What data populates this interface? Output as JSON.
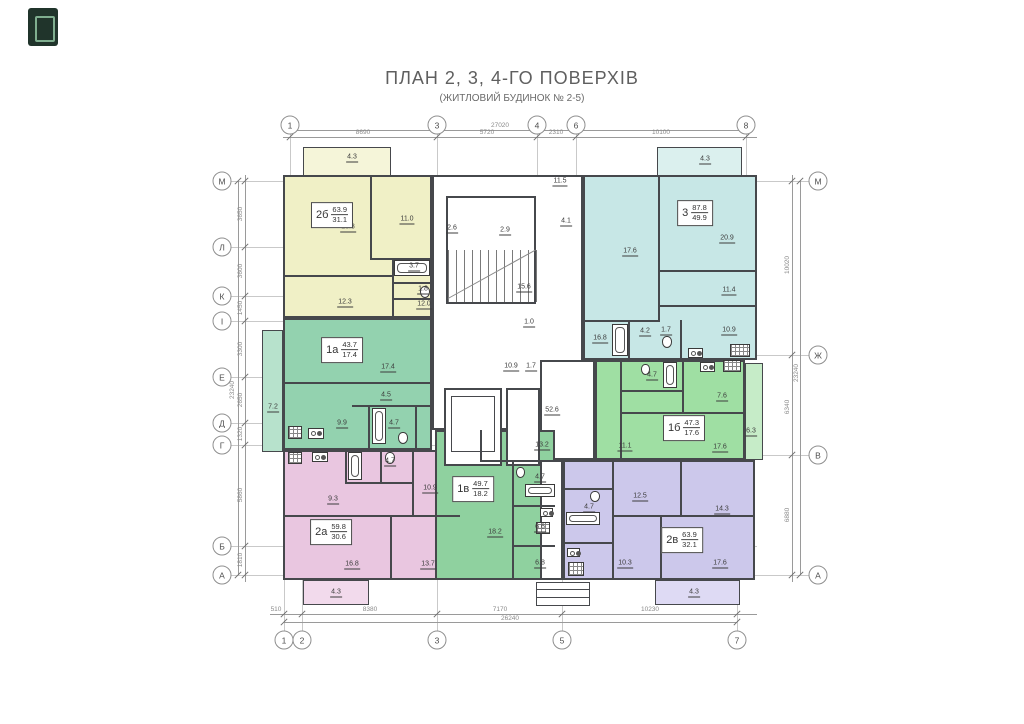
{
  "title": "ПЛАН 2, 3, 4-ГО ПОВЕРХІВ",
  "subtitle": "(ЖИТЛОВИЙ БУДИНОК № 2-5)",
  "colors": {
    "a2b": "#f0f0c6",
    "a2b_b": "#f5f5d9",
    "a3": "#c7e7e6",
    "a3_b": "#dbf0ee",
    "a1a": "#93d2af",
    "a1a_b": "#b7e2cc",
    "a1b": "#9fdfa3",
    "a1b_b": "#c6ecc8",
    "a2a": "#e9c6e0",
    "a2a_b": "#f2daec",
    "a1v": "#8fd19f",
    "a2v": "#ccc8eb",
    "a2v_b": "#dedaf4",
    "white": "#ffffff"
  },
  "apartments": [
    {
      "id": "2б",
      "total": "63.9",
      "living": "31.1",
      "x": 332,
      "y": 215
    },
    {
      "id": "3",
      "total": "87.8",
      "living": "49.9",
      "x": 695,
      "y": 213
    },
    {
      "id": "1а",
      "total": "43.7",
      "living": "17.4",
      "x": 342,
      "y": 350
    },
    {
      "id": "1б",
      "total": "47.3",
      "living": "17.6",
      "x": 684,
      "y": 428
    },
    {
      "id": "2а",
      "total": "59.8",
      "living": "30.6",
      "x": 331,
      "y": 532
    },
    {
      "id": "1в",
      "total": "49.7",
      "living": "18.2",
      "x": 473,
      "y": 489
    },
    {
      "id": "2в",
      "total": "63.9",
      "living": "32.1",
      "x": 682,
      "y": 540
    }
  ],
  "rooms": [
    {
      "x": 303,
      "y": 147,
      "w": 88,
      "h": 30,
      "f": "a2b_b",
      "thin": true
    },
    {
      "x": 657,
      "y": 147,
      "w": 85,
      "h": 30,
      "f": "a3_b",
      "thin": true
    },
    {
      "x": 283,
      "y": 175,
      "w": 149,
      "h": 143,
      "f": "a2b"
    },
    {
      "x": 432,
      "y": 175,
      "w": 151,
      "h": 255,
      "f": "white"
    },
    {
      "x": 583,
      "y": 175,
      "w": 174,
      "h": 185,
      "f": "a3"
    },
    {
      "x": 262,
      "y": 330,
      "w": 21,
      "h": 122,
      "f": "a1a_b",
      "thin": true,
      "hatch": true
    },
    {
      "x": 283,
      "y": 318,
      "w": 149,
      "h": 132,
      "f": "a1a"
    },
    {
      "x": 540,
      "y": 360,
      "w": 55,
      "h": 100,
      "f": "white"
    },
    {
      "x": 595,
      "y": 360,
      "w": 150,
      "h": 100,
      "f": "a1b"
    },
    {
      "x": 745,
      "y": 363,
      "w": 18,
      "h": 97,
      "f": "a1b_b",
      "thin": true,
      "hatch": true
    },
    {
      "x": 283,
      "y": 450,
      "w": 177,
      "h": 130,
      "f": "a2a"
    },
    {
      "x": 435,
      "y": 430,
      "w": 120,
      "h": 150,
      "f": "a1v"
    },
    {
      "x": 540,
      "y": 460,
      "w": 23,
      "h": 120,
      "f": "white"
    },
    {
      "x": 563,
      "y": 460,
      "w": 192,
      "h": 120,
      "f": "a2v"
    },
    {
      "x": 303,
      "y": 580,
      "w": 66,
      "h": 25,
      "f": "a2a_b",
      "thin": true
    },
    {
      "x": 655,
      "y": 580,
      "w": 85,
      "h": 25,
      "f": "a2v_b",
      "thin": true
    },
    {
      "x": 446,
      "y": 196,
      "w": 90,
      "h": 108,
      "f": "white"
    },
    {
      "x": 444,
      "y": 388,
      "w": 58,
      "h": 78,
      "f": "white"
    },
    {
      "x": 451,
      "y": 396,
      "w": 44,
      "h": 56,
      "f": "white",
      "thin": true
    },
    {
      "x": 506,
      "y": 388,
      "w": 34,
      "h": 78,
      "f": "white"
    },
    {
      "x": 536,
      "y": 582,
      "w": 54,
      "h": 24,
      "f": "white",
      "thin": true
    }
  ],
  "walls": [
    {
      "x": 370,
      "y": 175,
      "w": 2,
      "h": 85
    },
    {
      "x": 370,
      "y": 258,
      "w": 62,
      "h": 2
    },
    {
      "x": 392,
      "y": 258,
      "w": 2,
      "h": 60
    },
    {
      "x": 392,
      "y": 282,
      "w": 40,
      "h": 2
    },
    {
      "x": 392,
      "y": 298,
      "w": 40,
      "h": 2
    },
    {
      "x": 283,
      "y": 275,
      "w": 110,
      "h": 2
    },
    {
      "x": 658,
      "y": 177,
      "w": 2,
      "h": 143
    },
    {
      "x": 658,
      "y": 270,
      "w": 99,
      "h": 2
    },
    {
      "x": 658,
      "y": 305,
      "w": 99,
      "h": 2
    },
    {
      "x": 583,
      "y": 320,
      "w": 77,
      "h": 2
    },
    {
      "x": 628,
      "y": 320,
      "w": 2,
      "h": 40
    },
    {
      "x": 680,
      "y": 320,
      "w": 2,
      "h": 40
    },
    {
      "x": 283,
      "y": 382,
      "w": 149,
      "h": 2
    },
    {
      "x": 352,
      "y": 405,
      "w": 80,
      "h": 2
    },
    {
      "x": 368,
      "y": 405,
      "w": 2,
      "h": 45
    },
    {
      "x": 415,
      "y": 405,
      "w": 2,
      "h": 45
    },
    {
      "x": 620,
      "y": 360,
      "w": 2,
      "h": 100
    },
    {
      "x": 620,
      "y": 412,
      "w": 125,
      "h": 2
    },
    {
      "x": 620,
      "y": 390,
      "w": 62,
      "h": 2
    },
    {
      "x": 682,
      "y": 360,
      "w": 2,
      "h": 52
    },
    {
      "x": 283,
      "y": 515,
      "w": 177,
      "h": 2
    },
    {
      "x": 390,
      "y": 515,
      "w": 2,
      "h": 65
    },
    {
      "x": 412,
      "y": 450,
      "w": 2,
      "h": 65
    },
    {
      "x": 345,
      "y": 450,
      "w": 2,
      "h": 34
    },
    {
      "x": 345,
      "y": 482,
      "w": 67,
      "h": 2
    },
    {
      "x": 380,
      "y": 450,
      "w": 2,
      "h": 32
    },
    {
      "x": 512,
      "y": 460,
      "w": 2,
      "h": 120
    },
    {
      "x": 480,
      "y": 430,
      "w": 2,
      "h": 30
    },
    {
      "x": 480,
      "y": 460,
      "w": 75,
      "h": 2
    },
    {
      "x": 512,
      "y": 505,
      "w": 43,
      "h": 2
    },
    {
      "x": 512,
      "y": 545,
      "w": 43,
      "h": 2
    },
    {
      "x": 612,
      "y": 460,
      "w": 2,
      "h": 120
    },
    {
      "x": 612,
      "y": 515,
      "w": 143,
      "h": 2
    },
    {
      "x": 660,
      "y": 515,
      "w": 2,
      "h": 65
    },
    {
      "x": 680,
      "y": 460,
      "w": 2,
      "h": 55
    },
    {
      "x": 563,
      "y": 488,
      "w": 49,
      "h": 2
    },
    {
      "x": 563,
      "y": 542,
      "w": 49,
      "h": 2
    },
    {
      "x": 537,
      "y": 589,
      "w": 52,
      "h": 1
    },
    {
      "x": 537,
      "y": 597,
      "w": 52,
      "h": 1
    }
  ],
  "area_labels": [
    {
      "t": "4.3",
      "x": 352,
      "y": 158
    },
    {
      "t": "18.8",
      "x": 348,
      "y": 228
    },
    {
      "t": "11.0",
      "x": 407,
      "y": 220
    },
    {
      "t": "3.7",
      "x": 414,
      "y": 267
    },
    {
      "t": "1.8",
      "x": 423,
      "y": 290
    },
    {
      "t": "12.3",
      "x": 345,
      "y": 303
    },
    {
      "t": "12.0",
      "x": 424,
      "y": 305
    },
    {
      "t": "2.6",
      "x": 452,
      "y": 229
    },
    {
      "t": "2.9",
      "x": 505,
      "y": 231
    },
    {
      "t": "11.5",
      "x": 560,
      "y": 182
    },
    {
      "t": "4.1",
      "x": 566,
      "y": 222
    },
    {
      "t": "15.6",
      "x": 524,
      "y": 288
    },
    {
      "t": "1.0",
      "x": 529,
      "y": 323
    },
    {
      "t": "10.9",
      "x": 511,
      "y": 367
    },
    {
      "t": "1.7",
      "x": 531,
      "y": 367
    },
    {
      "t": "52.6",
      "x": 552,
      "y": 411
    },
    {
      "t": "4.3",
      "x": 705,
      "y": 160
    },
    {
      "t": "17.6",
      "x": 630,
      "y": 252
    },
    {
      "t": "20.9",
      "x": 727,
      "y": 239
    },
    {
      "t": "11.4",
      "x": 729,
      "y": 291
    },
    {
      "t": "10.9",
      "x": 729,
      "y": 331
    },
    {
      "t": "16.8",
      "x": 600,
      "y": 339
    },
    {
      "t": "4.2",
      "x": 645,
      "y": 332
    },
    {
      "t": "1.7",
      "x": 666,
      "y": 331
    },
    {
      "t": "17.4",
      "x": 388,
      "y": 368
    },
    {
      "t": "4.5",
      "x": 386,
      "y": 396
    },
    {
      "t": "9.9",
      "x": 342,
      "y": 424
    },
    {
      "t": "4.7",
      "x": 394,
      "y": 424
    },
    {
      "t": "7.2",
      "x": 273,
      "y": 408
    },
    {
      "t": "4.7",
      "x": 652,
      "y": 376
    },
    {
      "t": "7.6",
      "x": 722,
      "y": 397
    },
    {
      "t": "11.1",
      "x": 625,
      "y": 447
    },
    {
      "t": "17.6",
      "x": 720,
      "y": 448
    },
    {
      "t": "6.3",
      "x": 751,
      "y": 432
    },
    {
      "t": "9.3",
      "x": 333,
      "y": 500
    },
    {
      "t": "4.7",
      "x": 390,
      "y": 462
    },
    {
      "t": "10.9",
      "x": 430,
      "y": 489
    },
    {
      "t": "16.8",
      "x": 352,
      "y": 565
    },
    {
      "t": "13.7",
      "x": 428,
      "y": 565
    },
    {
      "t": "4.3",
      "x": 336,
      "y": 593
    },
    {
      "t": "13.2",
      "x": 542,
      "y": 446
    },
    {
      "t": "4.7",
      "x": 540,
      "y": 478
    },
    {
      "t": "18.2",
      "x": 495,
      "y": 533
    },
    {
      "t": "6.6",
      "x": 540,
      "y": 528
    },
    {
      "t": "6.8",
      "x": 540,
      "y": 564
    },
    {
      "t": "12.5",
      "x": 640,
      "y": 497
    },
    {
      "t": "14.3",
      "x": 722,
      "y": 510
    },
    {
      "t": "10.3",
      "x": 625,
      "y": 564
    },
    {
      "t": "17.6",
      "x": 720,
      "y": 564
    },
    {
      "t": "4.7",
      "x": 589,
      "y": 508
    },
    {
      "t": "4.3",
      "x": 694,
      "y": 593
    }
  ],
  "axes": {
    "top": [
      {
        "l": "1",
        "x": 290
      },
      {
        "l": "3",
        "x": 437
      },
      {
        "l": "4",
        "x": 537
      },
      {
        "l": "6",
        "x": 576
      },
      {
        "l": "8",
        "x": 746
      }
    ],
    "top_y": 125,
    "bottom": [
      {
        "l": "1",
        "x": 284
      },
      {
        "l": "2",
        "x": 302
      },
      {
        "l": "3",
        "x": 437
      },
      {
        "l": "5",
        "x": 562
      },
      {
        "l": "7",
        "x": 737
      }
    ],
    "bottom_y": 640,
    "left": [
      {
        "l": "М",
        "y": 181
      },
      {
        "l": "Л",
        "y": 247
      },
      {
        "l": "К",
        "y": 296
      },
      {
        "l": "І",
        "y": 321
      },
      {
        "l": "Е",
        "y": 377
      },
      {
        "l": "Д",
        "y": 423
      },
      {
        "l": "Г",
        "y": 445
      },
      {
        "l": "Б",
        "y": 546
      },
      {
        "l": "А",
        "y": 575
      }
    ],
    "left_x": 222,
    "right": [
      {
        "l": "М",
        "y": 181
      },
      {
        "l": "Ж",
        "y": 355
      },
      {
        "l": "В",
        "y": 455
      },
      {
        "l": "А",
        "y": 575
      }
    ],
    "right_x": 818
  },
  "axis_lines": {
    "v": [
      {
        "x": 290,
        "y1": 134,
        "y2": 176
      },
      {
        "x": 437,
        "y1": 134,
        "y2": 631
      },
      {
        "x": 537,
        "y1": 134,
        "y2": 430
      },
      {
        "x": 576,
        "y1": 134,
        "y2": 412
      },
      {
        "x": 746,
        "y1": 134,
        "y2": 176
      },
      {
        "x": 284,
        "y1": 580,
        "y2": 631
      },
      {
        "x": 302,
        "y1": 580,
        "y2": 631
      },
      {
        "x": 562,
        "y1": 580,
        "y2": 631
      },
      {
        "x": 737,
        "y1": 580,
        "y2": 631
      }
    ],
    "h": [
      {
        "y": 181,
        "x1": 231,
        "x2": 809
      },
      {
        "y": 247,
        "x1": 231,
        "x2": 757
      },
      {
        "y": 296,
        "x1": 231,
        "x2": 757
      },
      {
        "y": 321,
        "x1": 231,
        "x2": 757
      },
      {
        "y": 377,
        "x1": 231,
        "x2": 757
      },
      {
        "y": 423,
        "x1": 231,
        "x2": 757
      },
      {
        "y": 445,
        "x1": 231,
        "x2": 757
      },
      {
        "y": 546,
        "x1": 231,
        "x2": 757
      },
      {
        "y": 575,
        "x1": 231,
        "x2": 809
      },
      {
        "y": 355,
        "x1": 757,
        "x2": 809
      },
      {
        "y": 455,
        "x1": 757,
        "x2": 809
      }
    ]
  },
  "dim_lines": [
    {
      "o": "h",
      "y": 130,
      "x1": 290,
      "x2": 746,
      "ticks": [
        290,
        746
      ]
    },
    {
      "o": "h",
      "y": 137,
      "x1": 283,
      "x2": 757,
      "ticks": [
        290,
        437,
        537,
        576,
        746
      ]
    },
    {
      "o": "h",
      "y": 614,
      "x1": 270,
      "x2": 757,
      "ticks": [
        284,
        302,
        437,
        562,
        737
      ]
    },
    {
      "o": "h",
      "y": 622,
      "x1": 284,
      "x2": 737,
      "ticks": [
        284,
        737
      ]
    },
    {
      "o": "v",
      "x": 245,
      "y1": 175,
      "y2": 582,
      "ticks": [
        181,
        247,
        296,
        321,
        377,
        423,
        445,
        546,
        575
      ]
    },
    {
      "o": "v",
      "x": 238,
      "y1": 181,
      "y2": 575,
      "ticks": [
        181,
        575
      ]
    },
    {
      "o": "v",
      "x": 792,
      "y1": 175,
      "y2": 582,
      "ticks": [
        181,
        355,
        455,
        575
      ]
    },
    {
      "o": "v",
      "x": 800,
      "y1": 181,
      "y2": 575,
      "ticks": [
        181,
        575
      ]
    }
  ],
  "dim_texts": [
    {
      "t": "27020",
      "x": 500,
      "y": 126
    },
    {
      "t": "8690",
      "x": 363,
      "y": 133
    },
    {
      "t": "5720",
      "x": 487,
      "y": 133
    },
    {
      "t": "2310",
      "x": 556,
      "y": 133
    },
    {
      "t": "10100",
      "x": 661,
      "y": 133
    },
    {
      "t": "510",
      "x": 276,
      "y": 610
    },
    {
      "t": "8380",
      "x": 370,
      "y": 610
    },
    {
      "t": "7170",
      "x": 500,
      "y": 610
    },
    {
      "t": "10230",
      "x": 650,
      "y": 610
    },
    {
      "t": "26240",
      "x": 510,
      "y": 619
    },
    {
      "t": "3650",
      "x": 241,
      "y": 214,
      "rot": true
    },
    {
      "t": "3600",
      "x": 241,
      "y": 271,
      "rot": true
    },
    {
      "t": "1450",
      "x": 241,
      "y": 308,
      "rot": true
    },
    {
      "t": "3300",
      "x": 241,
      "y": 349,
      "rot": true
    },
    {
      "t": "2650",
      "x": 241,
      "y": 400,
      "rot": true
    },
    {
      "t": "1320",
      "x": 241,
      "y": 434,
      "rot": true
    },
    {
      "t": "5860",
      "x": 241,
      "y": 495,
      "rot": true
    },
    {
      "t": "1810",
      "x": 241,
      "y": 560,
      "rot": true
    },
    {
      "t": "23240",
      "x": 233,
      "y": 390,
      "rot": true
    },
    {
      "t": "10020",
      "x": 788,
      "y": 265,
      "rot": true
    },
    {
      "t": "6340",
      "x": 788,
      "y": 407,
      "rot": true
    },
    {
      "t": "6880",
      "x": 788,
      "y": 515,
      "rot": true
    },
    {
      "t": "23240",
      "x": 797,
      "y": 373,
      "rot": true
    }
  ],
  "fixtures": [
    {
      "t": "tub",
      "x": 394,
      "y": 260,
      "w": 36,
      "h": 16
    },
    {
      "t": "wc",
      "x": 420,
      "y": 286,
      "w": 10,
      "h": 12
    },
    {
      "t": "tub",
      "x": 612,
      "y": 324,
      "w": 16,
      "h": 32
    },
    {
      "t": "wc",
      "x": 662,
      "y": 336,
      "w": 10,
      "h": 12
    },
    {
      "t": "stove",
      "x": 688,
      "y": 348,
      "w": 15,
      "h": 10
    },
    {
      "t": "grate",
      "x": 730,
      "y": 344,
      "w": 20,
      "h": 13
    },
    {
      "t": "tub",
      "x": 372,
      "y": 408,
      "w": 14,
      "h": 36
    },
    {
      "t": "wc",
      "x": 398,
      "y": 432,
      "w": 10,
      "h": 12
    },
    {
      "t": "stove",
      "x": 308,
      "y": 428,
      "w": 16,
      "h": 11
    },
    {
      "t": "grate",
      "x": 288,
      "y": 426,
      "w": 14,
      "h": 13
    },
    {
      "t": "tub",
      "x": 663,
      "y": 362,
      "w": 14,
      "h": 26
    },
    {
      "t": "wc",
      "x": 641,
      "y": 364,
      "w": 9,
      "h": 11
    },
    {
      "t": "stove",
      "x": 700,
      "y": 362,
      "w": 15,
      "h": 10
    },
    {
      "t": "grate",
      "x": 723,
      "y": 360,
      "w": 18,
      "h": 12
    },
    {
      "t": "grate",
      "x": 288,
      "y": 452,
      "w": 14,
      "h": 12
    },
    {
      "t": "stove",
      "x": 312,
      "y": 452,
      "w": 16,
      "h": 10
    },
    {
      "t": "tub",
      "x": 348,
      "y": 452,
      "w": 14,
      "h": 28
    },
    {
      "t": "wc",
      "x": 385,
      "y": 452,
      "w": 10,
      "h": 12
    },
    {
      "t": "tub",
      "x": 525,
      "y": 484,
      "w": 30,
      "h": 13
    },
    {
      "t": "wc",
      "x": 516,
      "y": 467,
      "w": 9,
      "h": 11
    },
    {
      "t": "stove",
      "x": 540,
      "y": 508,
      "w": 13,
      "h": 9
    },
    {
      "t": "grate",
      "x": 536,
      "y": 522,
      "w": 14,
      "h": 12
    },
    {
      "t": "tub",
      "x": 566,
      "y": 512,
      "w": 34,
      "h": 13
    },
    {
      "t": "wc",
      "x": 590,
      "y": 491,
      "w": 10,
      "h": 11
    },
    {
      "t": "stove",
      "x": 567,
      "y": 548,
      "w": 13,
      "h": 9
    },
    {
      "t": "grate",
      "x": 568,
      "y": 562,
      "w": 16,
      "h": 14
    }
  ],
  "stairs": {
    "x1": 448,
    "x2": 536,
    "y1": 250,
    "y2": 302,
    "count": 11,
    "diag": {
      "x": 448,
      "y": 298,
      "len": 100,
      "angle": -29
    }
  }
}
